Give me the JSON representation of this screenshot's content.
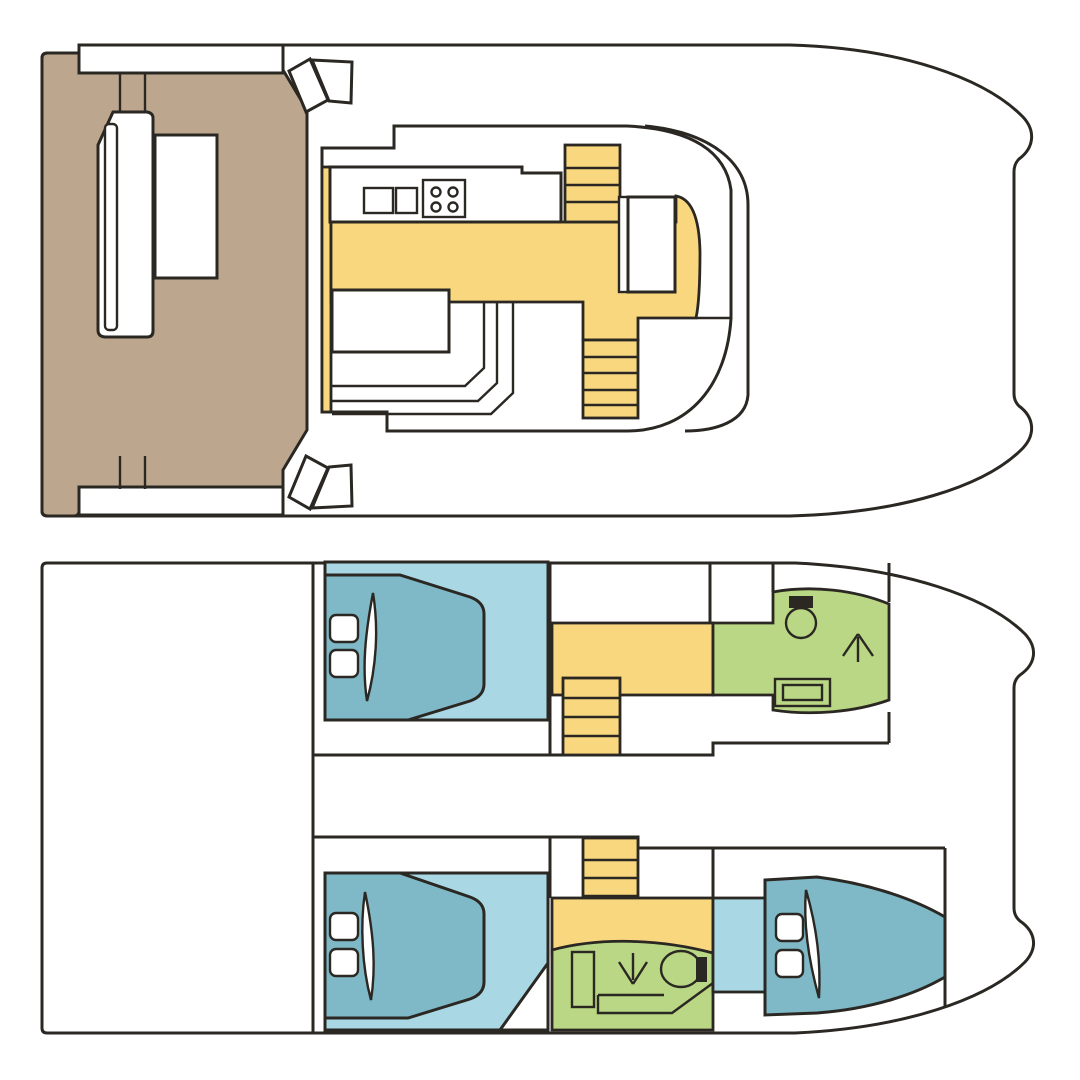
{
  "diagram": {
    "type": "boat-floor-plan",
    "vessel": "power-catamaran",
    "views": 2
  },
  "palette": {
    "ink": "#2b2823",
    "paper": "#ffffff",
    "cockpit_teak": "#bca78e",
    "walkway_yellow": "#f8d77e",
    "cabin_floor_blue": "#a9d8e4",
    "bed_teal": "#7fb9c7",
    "bathroom_green": "#b9d784"
  },
  "decks": [
    {
      "id": "upper-deck",
      "name": "Upper deck: aft cockpit, saloon, galley and foredeck",
      "areas": [
        {
          "name": "aft-cockpit",
          "color_key": "cockpit_teak"
        },
        {
          "name": "galley-walkway-floor",
          "color_key": "walkway_yellow"
        },
        {
          "name": "saloon",
          "color_key": "paper"
        },
        {
          "name": "foredeck",
          "color_key": "paper"
        }
      ],
      "features": [
        "transom-platform",
        "boarding-steps",
        "cockpit-bench",
        "cockpit-table",
        "galley-counter",
        "double-sink",
        "stove-4-burner",
        "stairs-up",
        "helm-seat",
        "saloon-table",
        "l-shaped-sofa",
        "stairs-down",
        "windshield"
      ]
    },
    {
      "id": "lower-deck",
      "name": "Lower deck: aft platform, two hulls with cabins and bathrooms",
      "areas": [
        {
          "name": "aft-platform",
          "color_key": "paper"
        },
        {
          "name": "starboard-aft-cabin",
          "color_key": "cabin_floor_blue"
        },
        {
          "name": "starboard-corridor",
          "color_key": "walkway_yellow"
        },
        {
          "name": "starboard-bathroom",
          "color_key": "bathroom_green"
        },
        {
          "name": "port-aft-cabin",
          "color_key": "cabin_floor_blue"
        },
        {
          "name": "port-corridor",
          "color_key": "walkway_yellow"
        },
        {
          "name": "port-bathroom",
          "color_key": "bathroom_green"
        },
        {
          "name": "port-bow-cabin",
          "color_key": "bed_teal"
        }
      ],
      "features": [
        "double-bed",
        "pillows",
        "duvet-fold",
        "companionway-stairs",
        "toilet",
        "washbasin",
        "shower-tray",
        "shower-bench",
        "arrow-up",
        "arrow-down"
      ]
    }
  ],
  "icons": [
    "stove-icon",
    "sink-icon",
    "toilet-icon",
    "washbasin-icon",
    "shower-icon",
    "bed-icon",
    "pillow-icon",
    "stairs-icon",
    "arrow-up-icon",
    "arrow-down-icon"
  ]
}
